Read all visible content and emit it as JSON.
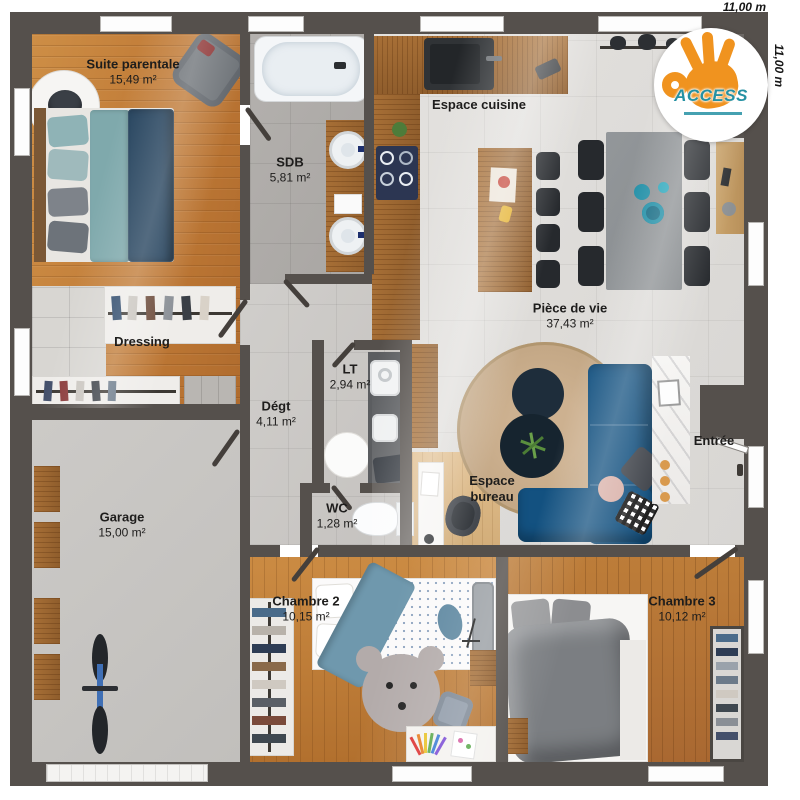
{
  "plan": {
    "dim_top": "11,00 m",
    "dim_right": "11,00 m"
  },
  "logo": {
    "brand": "ACCESS"
  },
  "rooms": {
    "suite": {
      "label": "Suite parentale",
      "area": "15,49 m²"
    },
    "sdb": {
      "label": "SDB",
      "area": "5,81 m²"
    },
    "cuisine": {
      "label": "Espace cuisine"
    },
    "vie": {
      "label": "Pièce de vie",
      "area": "37,43 m²"
    },
    "dressing": {
      "label": "Dressing"
    },
    "degt": {
      "label": "Dégt",
      "area": "4,11 m²"
    },
    "lt": {
      "label": "LT",
      "area": "2,94 m²"
    },
    "wc": {
      "label": "WC",
      "area": "1,28 m²"
    },
    "bureau": {
      "label": "Espace bureau"
    },
    "entree": {
      "label": "Entrée"
    },
    "garage": {
      "label": "Garage",
      "area": "15,00 m²"
    },
    "ch2": {
      "label": "Chambre 2",
      "area": "10,15 m²"
    },
    "ch3": {
      "label": "Chambre 3",
      "area": "10,12 m²"
    }
  },
  "colors": {
    "wall": "#55504c",
    "wood": "#c5863f",
    "tile": "#dfddda",
    "sofa": "#135180",
    "accent_teal": "#2591a3",
    "logo_orange": "#f0931f"
  }
}
